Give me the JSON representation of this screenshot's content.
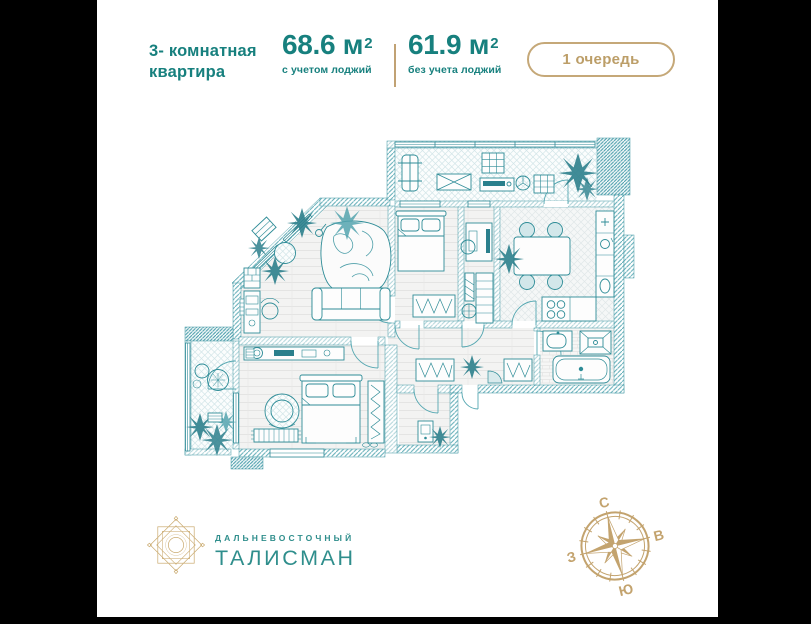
{
  "header": {
    "apartment_type": "3- комнатная квартира",
    "areas": [
      {
        "value": "68.6 м",
        "sup": "2",
        "label": "с учетом лоджий"
      },
      {
        "value": "61.9 м",
        "sup": "2",
        "label": "без учета лоджий"
      }
    ],
    "phase_badge": "1 очередь"
  },
  "branding": {
    "company_small": "ДАЛЬНЕВОСТОЧНЫЙ",
    "company_large": "ТАЛИСМАН"
  },
  "compass": {
    "north": "С",
    "east": "В",
    "south": "Ю",
    "west": "З"
  },
  "colors": {
    "teal_text": "#17807E",
    "logo_teal": "#2F8E8C",
    "gold": "#BC9E68",
    "plan_line": "#2E8C97",
    "plan_hatch": "#5FACB6"
  }
}
